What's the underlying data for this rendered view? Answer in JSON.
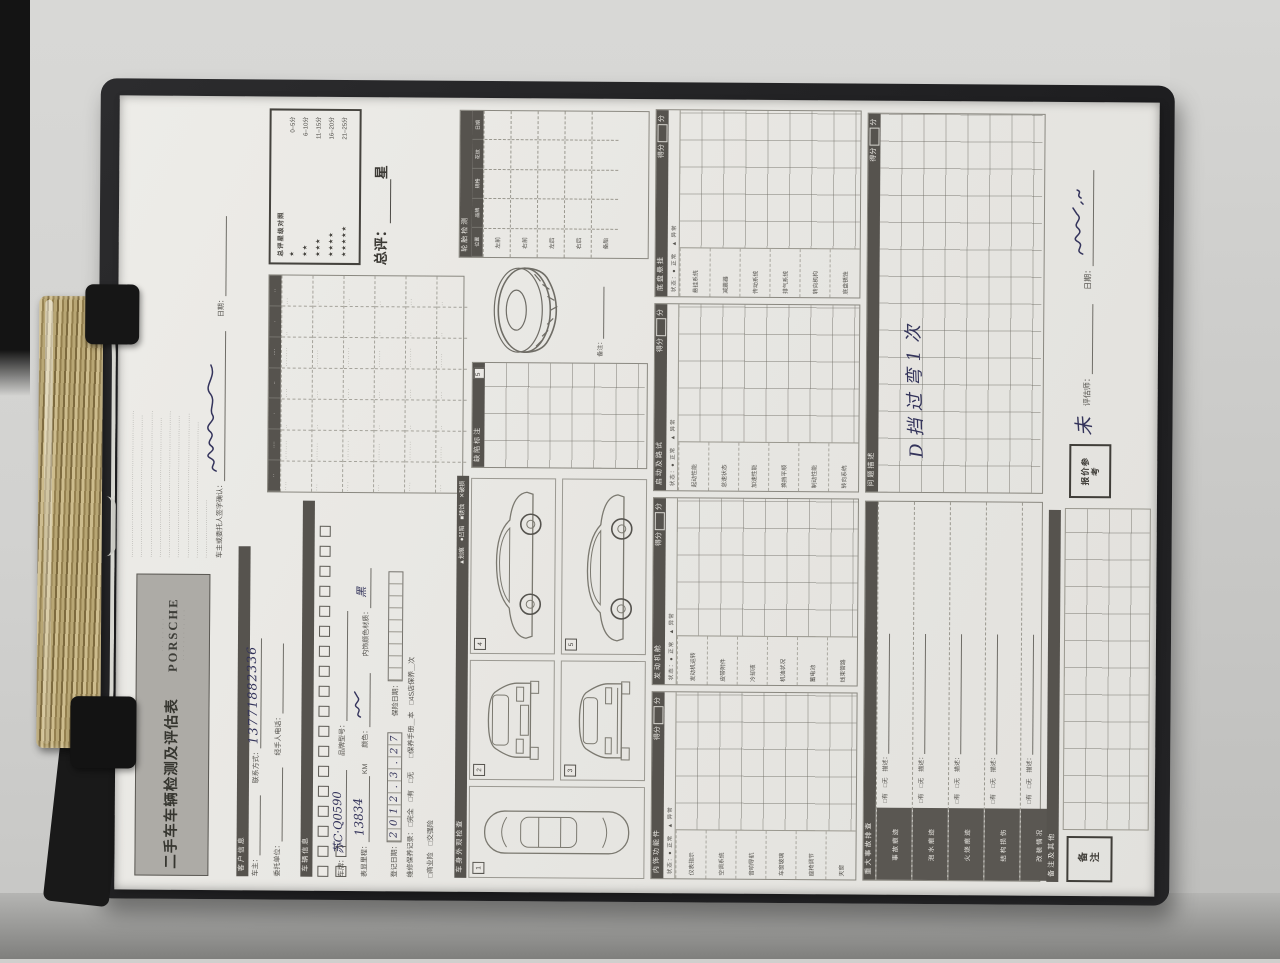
{
  "photo": {
    "background": "#cfcfcd",
    "clipboard_color": "#232325",
    "paper_color": "#eae9e5",
    "clip_metal_color": "#b8a674"
  },
  "header": {
    "title": "二手车车辆检测及评估表",
    "brand_top": "· · · · · · · ·",
    "brand": "PORSCHE",
    "brand_sub": "· · · · · · · · · · · ·",
    "disclaimer_lines": [
      "····································································",
      "··································································",
      "····································································",
      "·································································",
      "····································································",
      "··································································",
      "···································································",
      "·······························································",
      "···························"
    ],
    "sign_label": "车主或委托人签字确认：",
    "sign_date_label": "日期："
  },
  "customer": {
    "section": "客户信息",
    "owner_label": "车主：",
    "phone_label": "联系方式：",
    "phone_value": "13771882336",
    "agency_label": "委托单位：",
    "agent_label": "经手人电话："
  },
  "vehicle": {
    "section": "车辆信息",
    "checkbox_count": 20,
    "plate_label": "车牌：",
    "plate_value": "苏C·Q0590",
    "model_label": "品牌型号：",
    "mileage_label": "表显里程：",
    "mileage_value": "13834",
    "mileage_unit": "KM",
    "color_label": "颜色：",
    "interior_label": "内饰颜色材质：",
    "interior_value": "黑",
    "regdate_label": "登记日期：",
    "regdate_digits": [
      "2",
      "0",
      "1",
      "2",
      ".",
      "3",
      ".",
      "2",
      "7"
    ],
    "maint_label": "维修保养记录：",
    "maint_opts": "□完全　□有　□无",
    "maint_opts2": "□保养手册＿本　□4S店保养＿次",
    "ins_label": "保险日期：",
    "ins_cells": 9,
    "ins_opts": "□商业险　□交强险"
  },
  "summary": {
    "headers": [
      "··",
      "····",
      "·",
      "··",
      "····",
      "·",
      "··"
    ],
    "rows": [
      [
        "····",
        "········",
        "··",
        "····",
        "········",
        "··",
        "···"
      ],
      [
        "···",
        "·······",
        "··",
        "···",
        "·······",
        "··",
        "··"
      ],
      [
        "····",
        "········",
        "··",
        "····",
        "········",
        "··",
        "···"
      ],
      [
        "···",
        "·······",
        "··",
        "···",
        "·······",
        "··",
        "··"
      ],
      [
        "····",
        "········",
        "··",
        "····",
        "········",
        "··",
        "···"
      ],
      [
        "···",
        "······",
        "··",
        "···",
        "······",
        "··",
        "··"
      ]
    ]
  },
  "overall": {
    "legend_title": "总评星级对照",
    "legend": [
      {
        "stars": "★",
        "range": "0–5分"
      },
      {
        "stars": "★★",
        "range": "6–10分"
      },
      {
        "stars": "★★★",
        "range": "11–15分"
      },
      {
        "stars": "★★★★",
        "range": "16–20分"
      },
      {
        "stars": "★★★★★",
        "range": "21–25分"
      }
    ],
    "label": "总评：",
    "unit": "星"
  },
  "exterior": {
    "section": "车身外观检查",
    "symbols": "▲划痕　●凹陷　■锈蚀　✕破损",
    "panel_label": "缺陷标注",
    "view_nums": [
      "1",
      "2",
      "3",
      "4",
      "5"
    ]
  },
  "tires": {
    "section": "轮胎检测",
    "columns": [
      "位置",
      "品牌",
      "规格",
      "花纹",
      "日期"
    ],
    "rows": [
      "左前",
      "右前",
      "左后",
      "右后",
      "备胎"
    ],
    "note_label": "备注："
  },
  "blocks": {
    "status": "状态：● 正常　▲ 异常",
    "score_label": "得分",
    "score_unit": "分",
    "list": [
      {
        "name": "内饰功能件",
        "items": [
          "仪表指示",
          "空调系统",
          "音响导航",
          "车窗玻璃",
          "座椅调节",
          "天窗"
        ]
      },
      {
        "name": "发动机舱",
        "items": [
          "发动机运转",
          "皮带附件",
          "冷却液",
          "机油状况",
          "蓄电池",
          "线束管路"
        ]
      },
      {
        "name": "启动及路试",
        "items": [
          "起动性能",
          "怠速状态",
          "加速性能",
          "换挡平顺",
          "制动性能",
          "转向系统"
        ]
      },
      {
        "name": "底盘悬挂",
        "items": [
          "悬挂系统",
          "减震器",
          "传动系统",
          "排气系统",
          "转向机构",
          "底盘锈蚀"
        ]
      }
    ]
  },
  "inspection": {
    "section": "重大事故排查",
    "rows": [
      {
        "label": "事故痕迹"
      },
      {
        "label": "泡水痕迹"
      },
      {
        "label": "火烧痕迹"
      },
      {
        "label": "结构损伤"
      },
      {
        "label": "改装情况"
      }
    ],
    "opts": "□有　□无　描述：",
    "desc_section": "问题描述",
    "handwriting": "D挡过弯1次",
    "score_label": "得分",
    "score_unit": "分"
  },
  "footer": {
    "bar_label": "备注及其他",
    "remark_label": "备注",
    "price_label": "报价参考",
    "price_value": "未",
    "appraiser_label": "评估师：",
    "date_label": "日期："
  }
}
